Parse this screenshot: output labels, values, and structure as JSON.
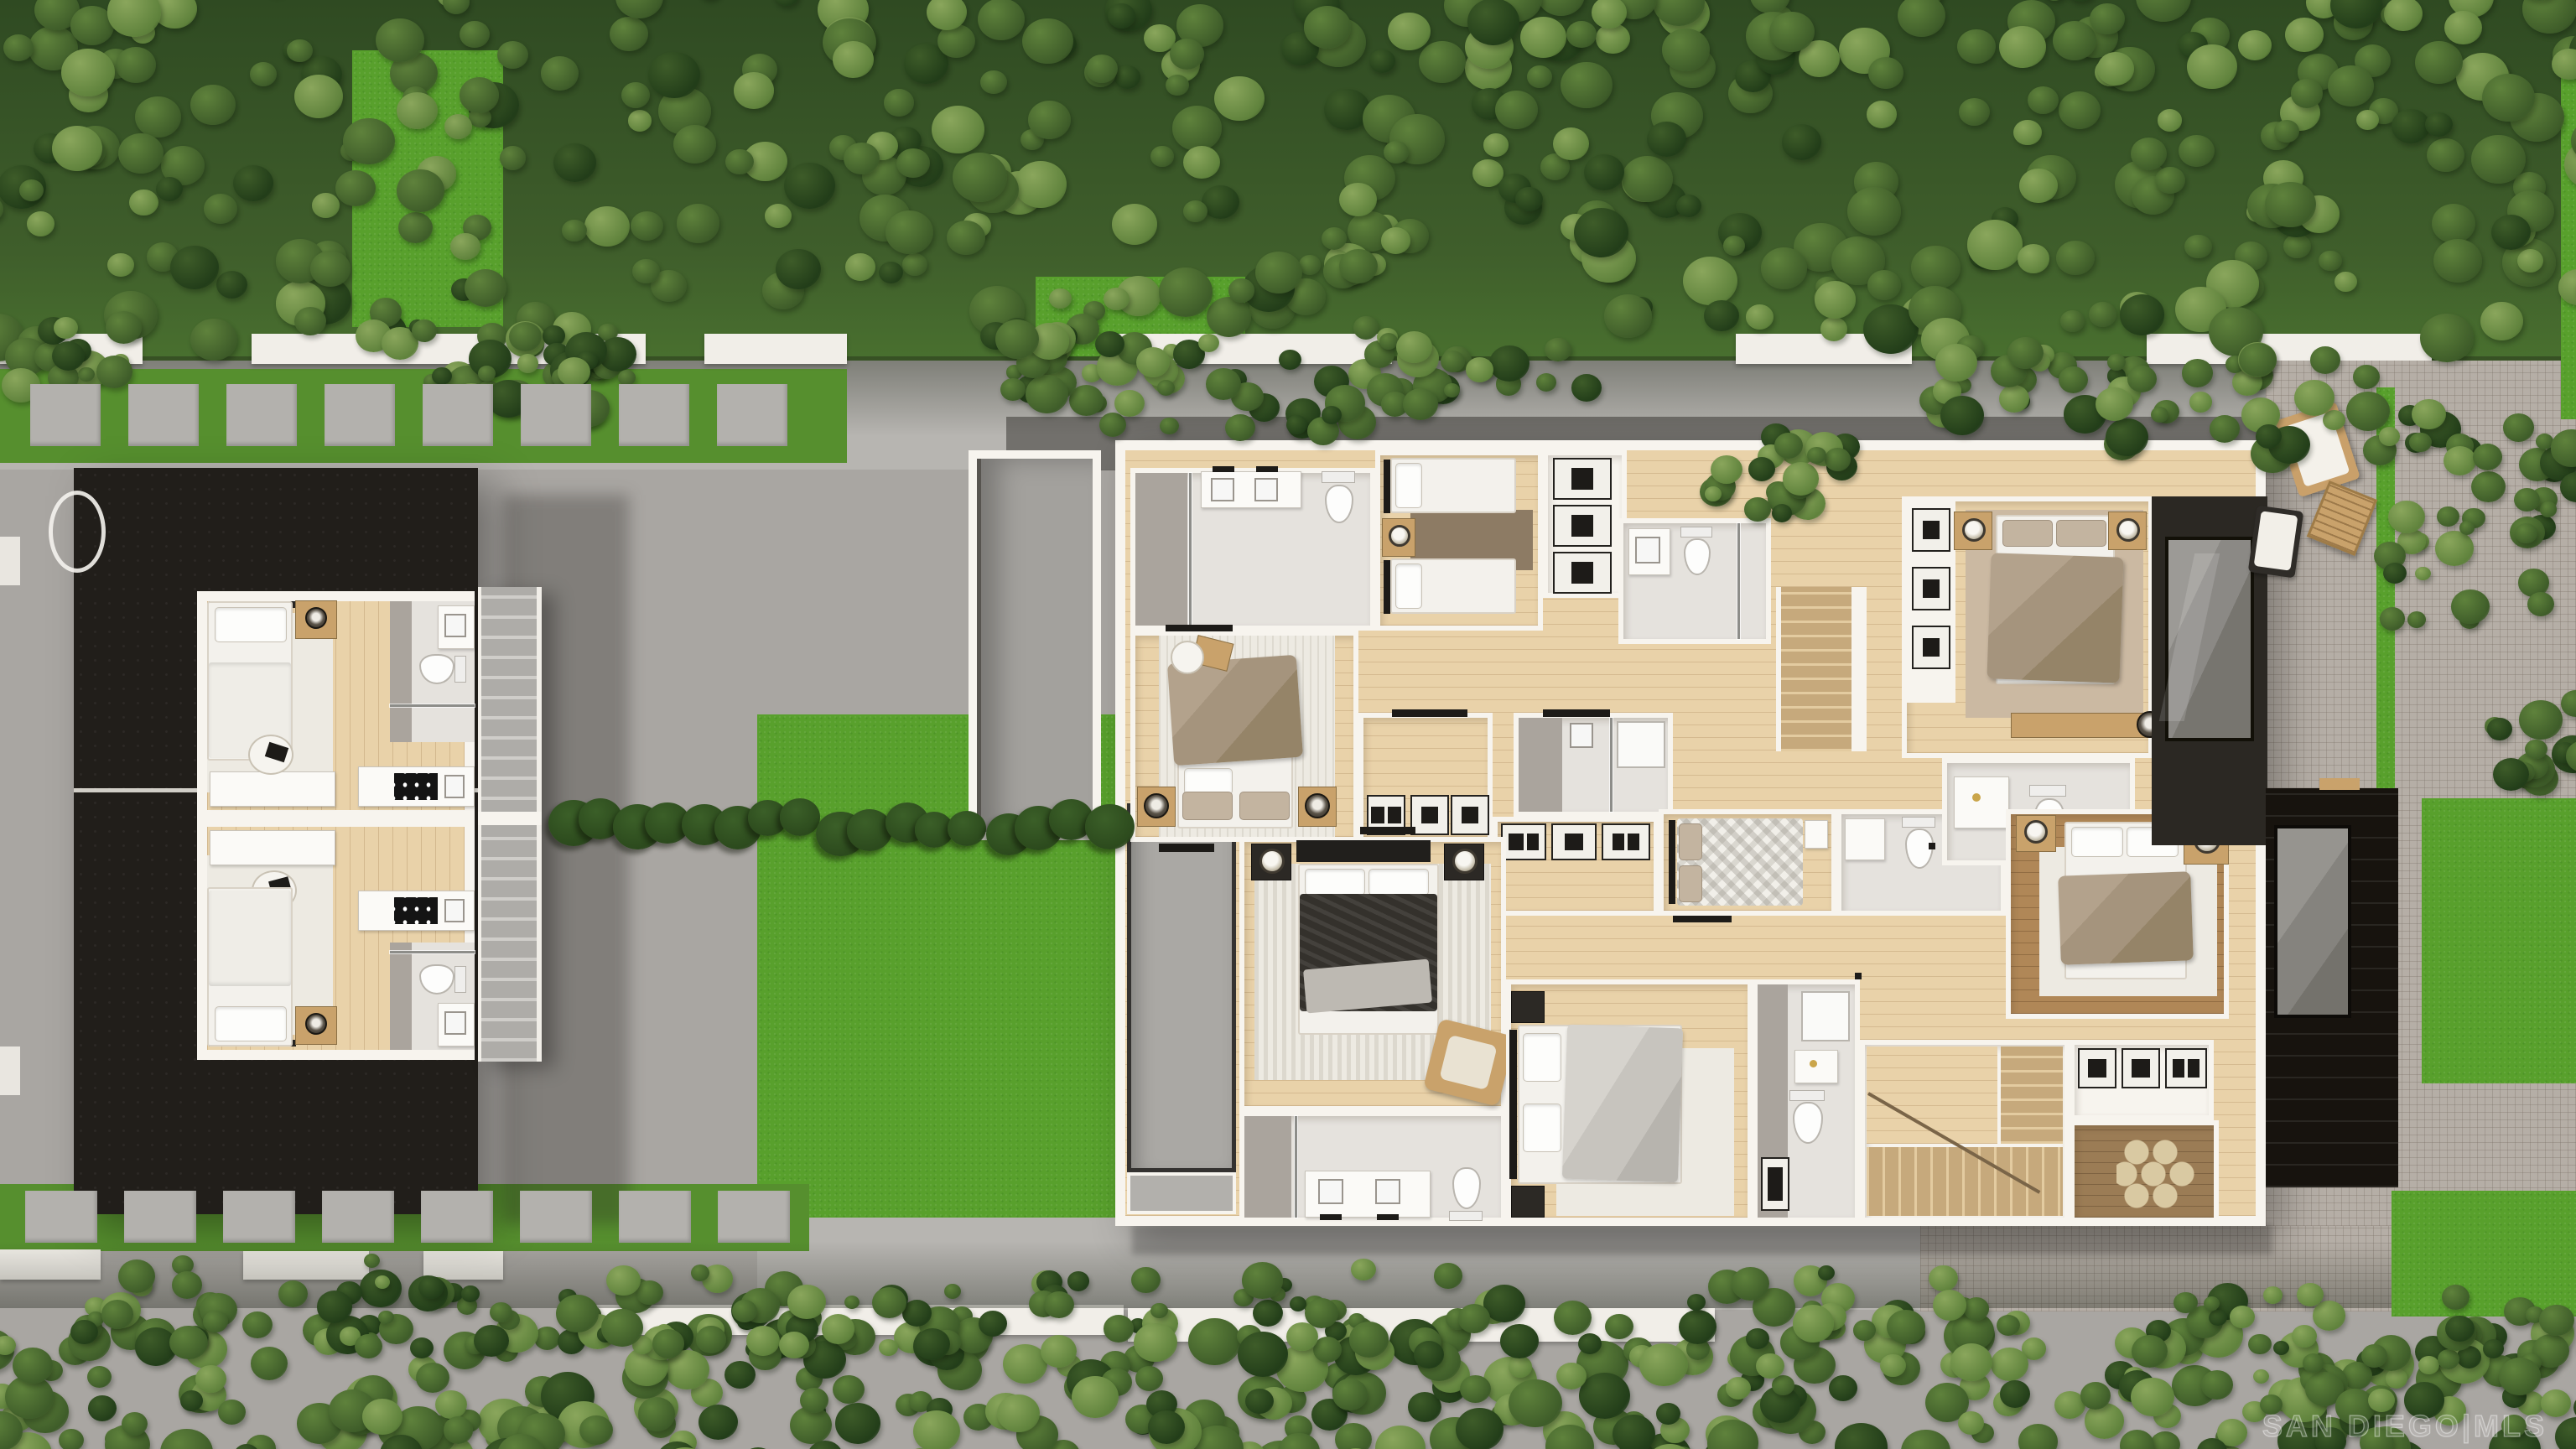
{
  "watermark": {
    "text": "SAN DIEGO|MLS"
  },
  "palette": {
    "pavement": "#a9a6a2",
    "walkway": "#b7b5b1",
    "brick": "#b5aea6",
    "lawn": "#58a02c",
    "grass_strip": "#568f2e",
    "hedge_dark": "#2c4a1d",
    "hedge_mid": "#3b5f28",
    "tree_light": "#8aa65c",
    "tree_mid": "#5f823c",
    "tree_dark": "#3e5c29",
    "tree_deep": "#223d19",
    "fence_white": "#f1eee8",
    "roof_black": "#211e1a",
    "deck_black": "#17130e",
    "wall_white": "#f7f4ee",
    "wood_floor": "#e9d2a9",
    "wood_warm": "#c9a26b",
    "wood_dark": "#8f7351",
    "tile": "#e5e2dd",
    "tile_gray": "#aaa49d",
    "glass_gray": "#91908c",
    "linen_white": "#f3f1ec",
    "duvet_taupe": "#a5947d",
    "duvet_dark": "#34312c",
    "duvet_gray": "#ccc9c3",
    "rug_light": "#edeae2",
    "rug_brown": "#8d7b64",
    "rug_tan": "#cbb9a2"
  }
}
